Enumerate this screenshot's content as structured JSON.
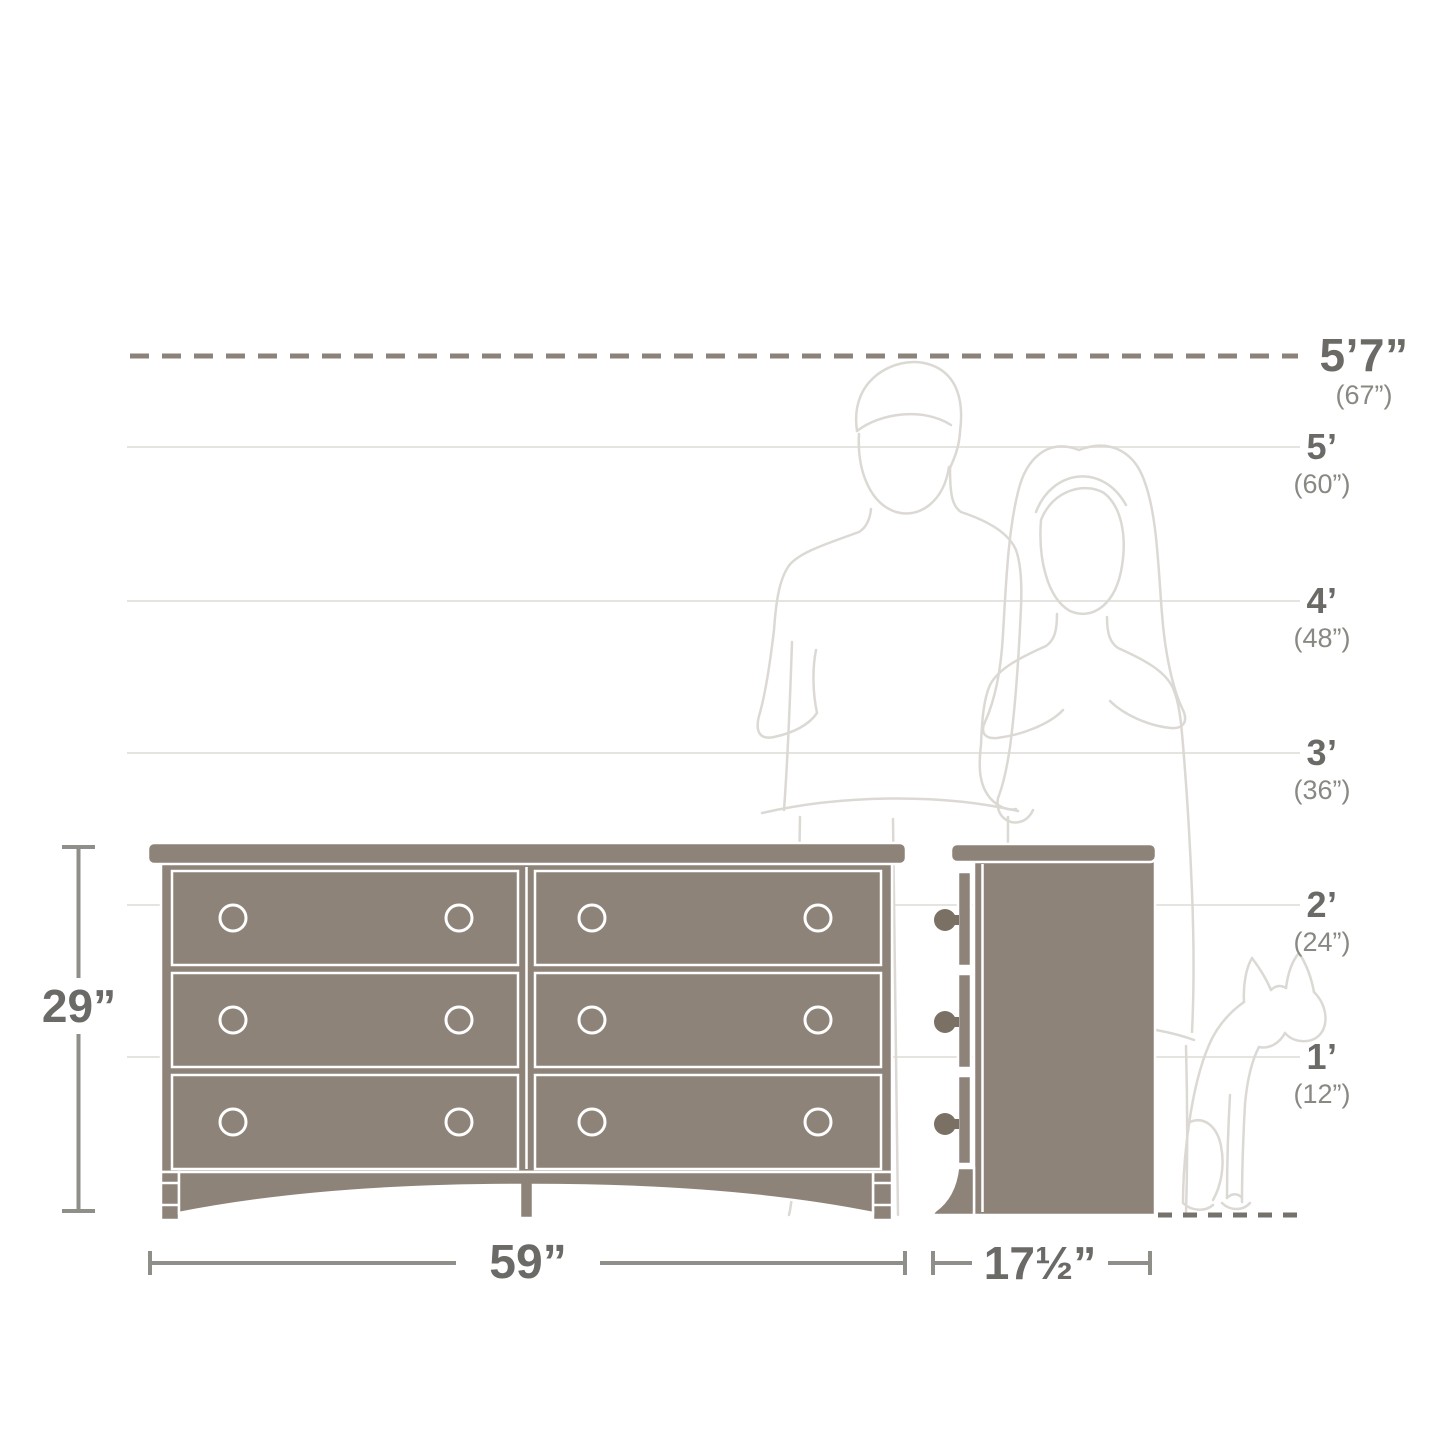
{
  "colors": {
    "background": "#ffffff",
    "dresser_fill": "#8e8379",
    "dresser_outline": "#ffffff",
    "knob_dark": "#7b7064",
    "gridline": "#e6e4e0",
    "dashed_line": "#8b8379",
    "dashed_line_floor": "#75726c",
    "dimension_line": "#8f8e89",
    "label_primary": "#6c6a67",
    "label_secondary": "#8a8883",
    "figure_outline": "#dcd9d4"
  },
  "scale_labels": [
    {
      "primary": "5’7”",
      "secondary": "(67”)"
    },
    {
      "primary": "5’",
      "secondary": "(60”)"
    },
    {
      "primary": "4’",
      "secondary": "(48”)"
    },
    {
      "primary": "3’",
      "secondary": "(36”)"
    },
    {
      "primary": "2’",
      "secondary": "(24”)"
    },
    {
      "primary": "1’",
      "secondary": "(12”)"
    }
  ],
  "dimensions": {
    "height": "29”",
    "width": "59”",
    "depth": "17½”"
  }
}
